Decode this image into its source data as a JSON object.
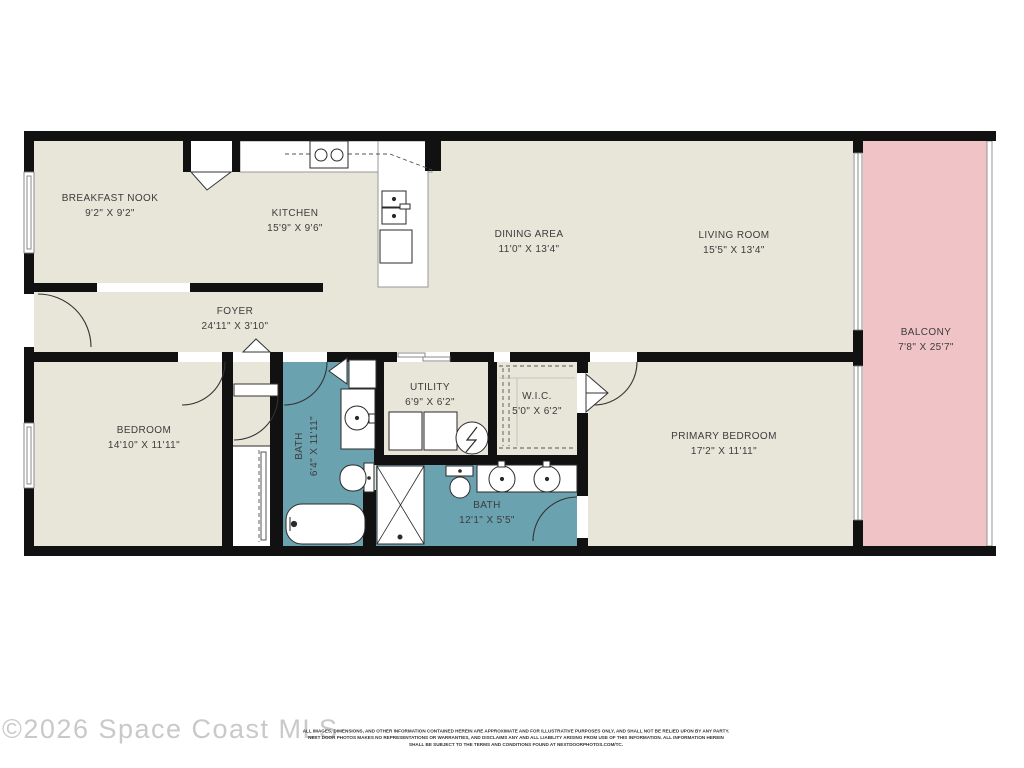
{
  "watermark": "©2026 Space Coast MLS",
  "disclaimer": {
    "line1": "ALL IMAGES, DIMENSIONS, AND OTHER INFORMATION CONTAINED HEREIN ARE APPROXIMATE AND FOR ILLUSTRATIVE PURPOSES ONLY, AND SHALL NOT BE RELIED UPON BY ANY PARTY.",
    "line2": "NEXT DOOR PHOTOS MAKES NO REPRESENTATIONS OR WARRANTIES, AND DISCLAIMS ANY AND ALL LIABILITY ARISING FROM USE OF THIS INFORMATION. ALL INFORMATION HEREIN",
    "line3": "SHALL BE SUBJECT TO THE TERMS AND CONDITIONS FOUND AT NEXTDOORPHOTOS.COM/TC."
  },
  "floorplan": {
    "colors": {
      "floor": "#e8e5d9",
      "bath": "#6ba2b0",
      "balcony": "#f0c4c6",
      "wall": "#111111"
    },
    "rooms": {
      "breakfast_nook": {
        "name": "BREAKFAST NOOK",
        "dims": "9'2\" X 9'2\""
      },
      "kitchen": {
        "name": "KITCHEN",
        "dims": "15'9\" X 9'6\""
      },
      "dining_area": {
        "name": "DINING AREA",
        "dims": "11'0\" X 13'4\""
      },
      "living_room": {
        "name": "LIVING ROOM",
        "dims": "15'5\" X 13'4\""
      },
      "foyer": {
        "name": "FOYER",
        "dims": "24'11\" X 3'10\""
      },
      "balcony": {
        "name": "BALCONY",
        "dims": "7'8\" X 25'7\""
      },
      "bedroom": {
        "name": "BEDROOM",
        "dims": "14'10\" X 11'11\""
      },
      "bath_hall": {
        "name": "BATH",
        "dims": "6'4\" X 11'11\""
      },
      "utility": {
        "name": "UTILITY",
        "dims": "6'9\" X 6'2\""
      },
      "wic": {
        "name": "W.I.C.",
        "dims": "5'0\" X 6'2\""
      },
      "bath_primary": {
        "name": "BATH",
        "dims": "12'1\" X 5'5\""
      },
      "primary_bedroom": {
        "name": "PRIMARY BEDROOM",
        "dims": "17'2\" X 11'11\""
      }
    }
  }
}
